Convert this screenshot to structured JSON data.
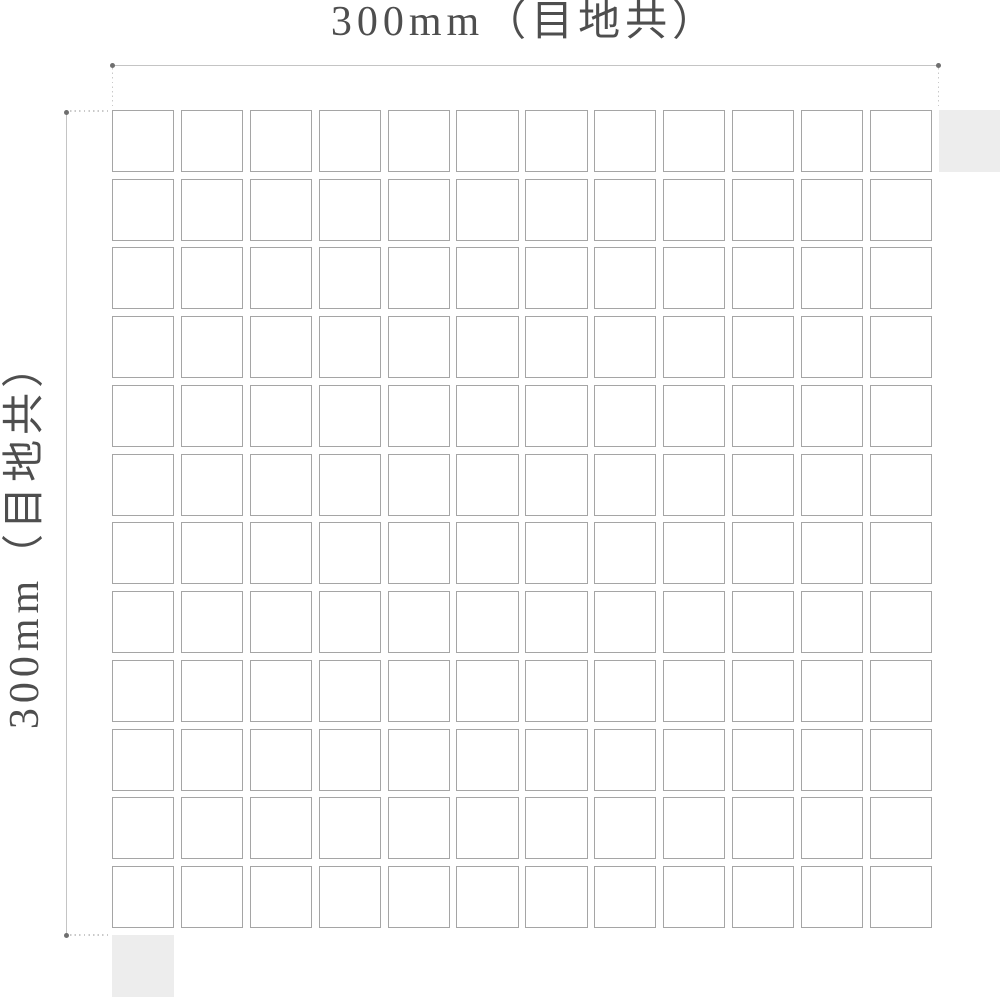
{
  "drawing": {
    "type": "mosaic-tile-sheet-dimension-diagram",
    "sheet": {
      "rows": 12,
      "columns": 12,
      "tile_fill": "#ffffff",
      "tile_border": "#a5a5a5",
      "partial_tile_fill": "#ededed",
      "partial_tiles": [
        "top-right",
        "bottom-left"
      ]
    },
    "dimensions": {
      "horizontal": {
        "label": "300mm（目地共）"
      },
      "vertical": {
        "label": "300mm（目地共）"
      }
    },
    "colors": {
      "background": "#ffffff",
      "label_text": "#4e4e4e",
      "dimension_line": "#c4c4c4",
      "dimension_dot": "#6f6f6f",
      "extension_dots": "#c9c9c9",
      "tile_fill": "#ffffff",
      "tile_border": "#a5a5a5",
      "partial_tile_fill": "#ededed"
    }
  }
}
